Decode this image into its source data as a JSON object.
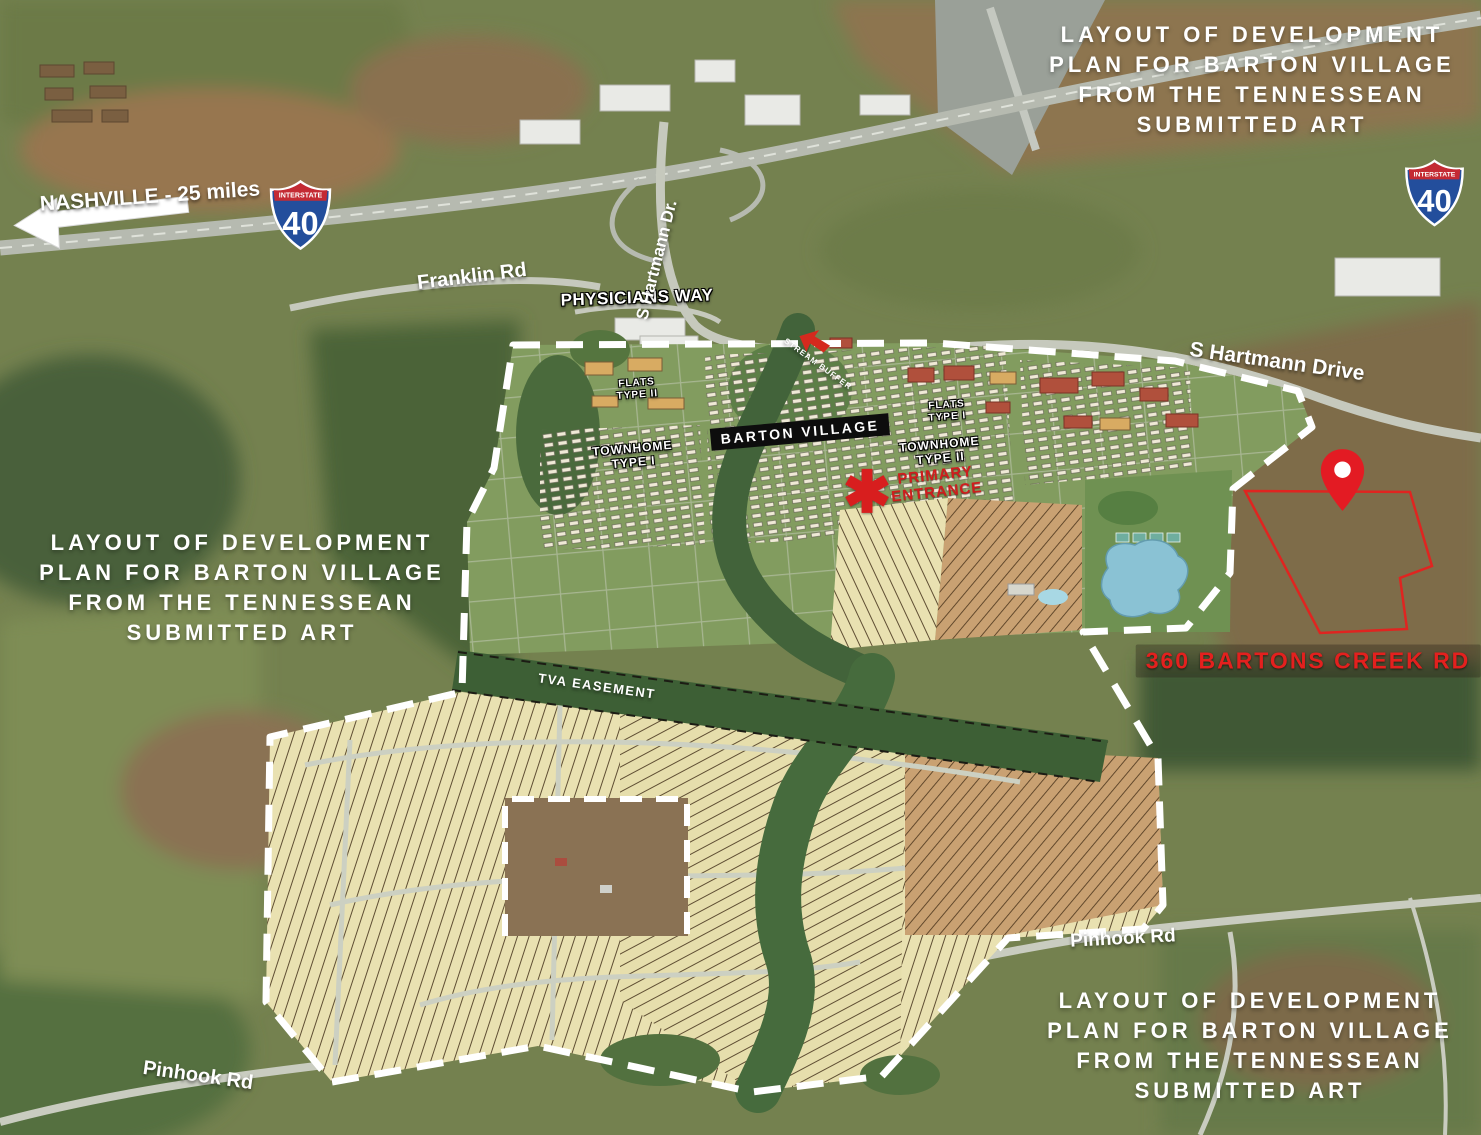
{
  "title": "Aerial layout of development plan for Barton Village",
  "credit": {
    "lines": [
      "LAYOUT OF DEVELOPMENT",
      "PLAN FOR BARTON VILLAGE",
      "FROM THE TENNESSEAN",
      "SUBMITTED ART"
    ]
  },
  "roads": {
    "nashville_distance": "NASHVILLE - 25 miles",
    "franklin": "Franklin Rd",
    "physicians_way": "PHYSICIANS WAY",
    "hartmann_short": "S Hartmann Dr.",
    "hartmann_long": "S Hartmann Drive",
    "pinhook": "Pinhook Rd"
  },
  "interstate": {
    "label": "INTERSTATE",
    "route": "40"
  },
  "plan": {
    "name": "BARTON VILLAGE",
    "townhome_type_1": [
      "TOWNHOME",
      "TYPE I"
    ],
    "townhome_type_2": [
      "TOWNHOME",
      "TYPE II"
    ],
    "flats_type_1": [
      "FLATS",
      "TYPE I"
    ],
    "flats_type_2": [
      "FLATS",
      "TYPE II"
    ],
    "stream_buffer": "STREAM BUFFER",
    "tva_easement": "TVA EASEMENT",
    "primary_entrance": [
      "PRIMARY",
      "ENTRANCE"
    ]
  },
  "property": {
    "address": "360 BARTONS CREEK RD"
  },
  "colors": {
    "accent_red": "#e02420",
    "entrance_red": "#cf1d1d",
    "boundary_white": "#ffffff",
    "banner_black": "#0d0d0d",
    "shield_blue": "#234e9c",
    "shield_red": "#c42a33",
    "plan_green": "#829c5f",
    "creek_green": "#42633a",
    "lot_cream": "#e9e1b1",
    "pond_blue": "#8ac2d4"
  }
}
